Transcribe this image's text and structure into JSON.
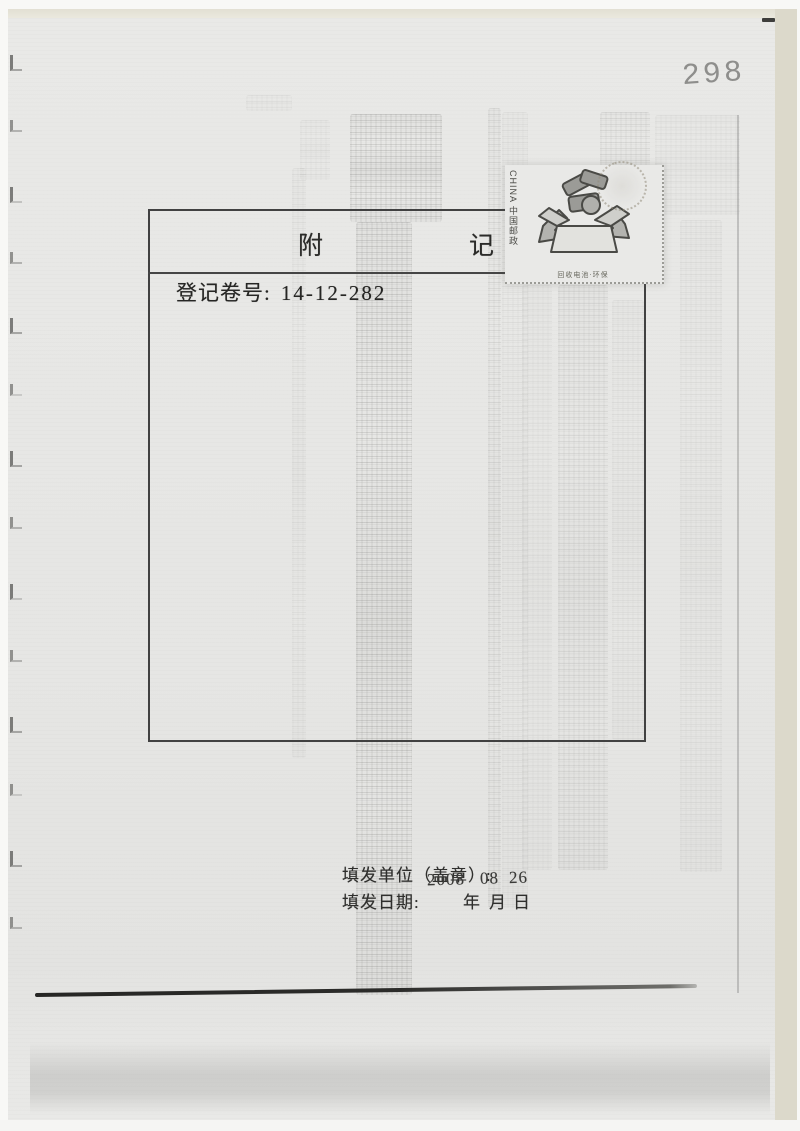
{
  "scan": {
    "page_number": "298"
  },
  "form": {
    "title_left": "附",
    "title_right": "记",
    "register_label": "登记卷号:",
    "register_value": "14-12-282"
  },
  "stamp": {
    "side_text": "CHINA 中国邮政",
    "caption": "回收电池·环保"
  },
  "footer": {
    "issuer_label": "填发单位（盖章）:",
    "date_label": "填发日期:",
    "unit_year": "年",
    "unit_month": "月",
    "unit_day": "日",
    "stamp_year": "2008",
    "stamp_month": "08",
    "stamp_day": "26"
  },
  "colors": {
    "paper": "#e7e7e5",
    "ink": "#2f2f2d",
    "box_line": "#414141"
  }
}
